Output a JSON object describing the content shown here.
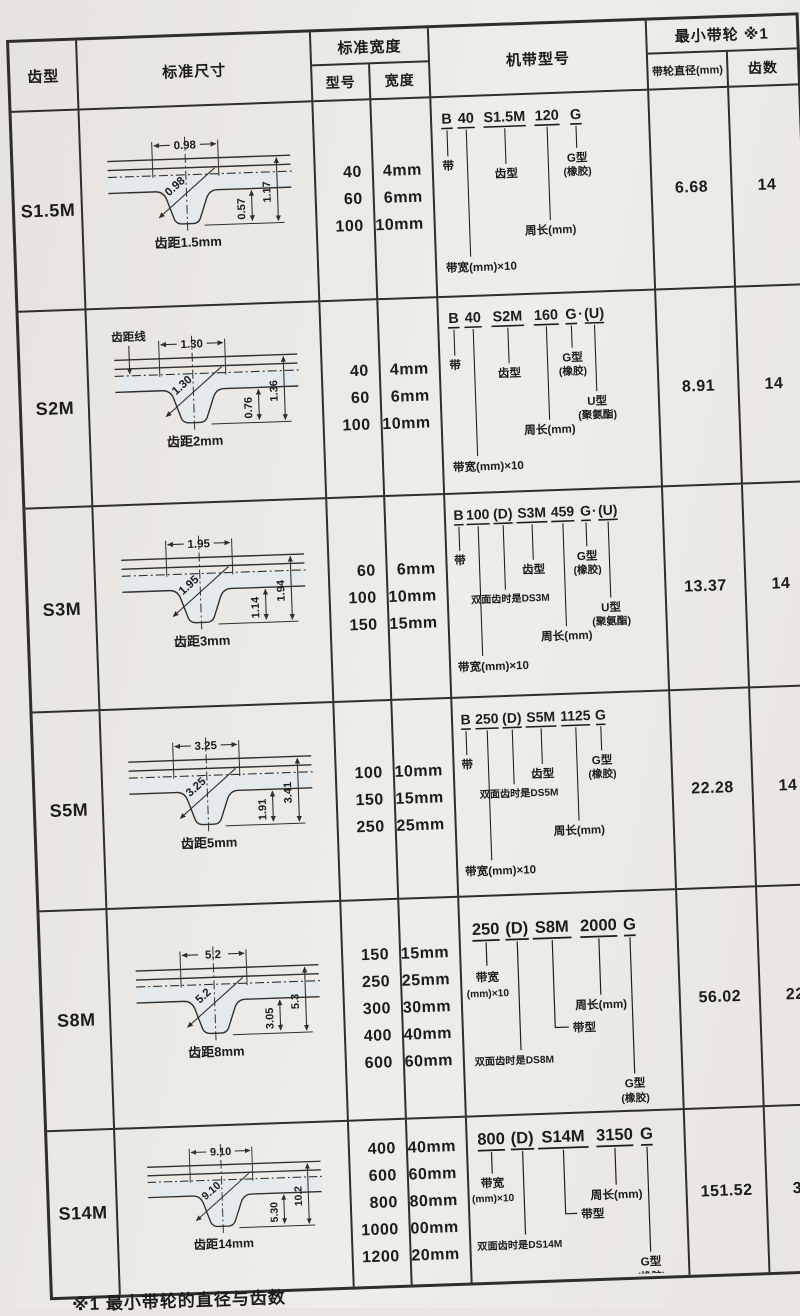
{
  "colors": {
    "paper": "#e9e6e1",
    "ink": "#1c1c1c",
    "grid_line": "#2e2e2e",
    "tooth_fill": "#e2e9ee"
  },
  "header": {
    "tooth_profile": "齿型",
    "standard_dims": "标准尺寸",
    "standard_width": "标准宽度",
    "model": "型号",
    "width": "宽度",
    "belt_model": "机带型号",
    "min_pulley": "最小带轮 ※1",
    "pulley_dia": "带轮直径(mm)",
    "teeth": "齿数"
  },
  "footnote": "※1 最小带轮的直径与齿数",
  "rows": [
    {
      "profile": "S1.5M",
      "diagram": {
        "top_width": "0.98",
        "tooth_width": "0.98",
        "tooth_height": "0.57",
        "total_height": "1.17",
        "pitch_label": "齿距1.5mm"
      },
      "models": [
        "40",
        "60",
        "100"
      ],
      "widths": [
        "4mm",
        "6mm",
        "10mm"
      ],
      "designation": {
        "belt_code": "B",
        "width_code": "40",
        "profile_code": "S1.5M",
        "length_code": "120",
        "type_code": "G",
        "label_belt": "带",
        "label_width": "带宽(mm)×10",
        "label_profile": "齿型",
        "label_length": "周长(mm)",
        "label_g1": "G型",
        "label_g2": "(橡胶)"
      },
      "pulley_dia": "6.68",
      "teeth": "14"
    },
    {
      "profile": "S2M",
      "diagram": {
        "top_width": "1.30",
        "tooth_width": "1.30",
        "tooth_height": "0.76",
        "total_height": "1.36",
        "pitch_label": "齿距2mm",
        "pitch_line_label": "齿距线"
      },
      "models": [
        "40",
        "60",
        "100"
      ],
      "widths": [
        "4mm",
        "6mm",
        "10mm"
      ],
      "designation": {
        "belt_code": "B",
        "width_code": "40",
        "profile_code": "S2M",
        "length_code": "160",
        "type_code": "G",
        "dot": "·",
        "u_code": "(U)",
        "label_belt": "带",
        "label_width": "带宽(mm)×10",
        "label_profile": "齿型",
        "label_length": "周长(mm)",
        "label_g1": "G型",
        "label_g2": "(橡胶)",
        "label_u1": "U型",
        "label_u2": "(聚氨酯)"
      },
      "pulley_dia": "8.91",
      "teeth": "14"
    },
    {
      "profile": "S3M",
      "diagram": {
        "top_width": "1.95",
        "tooth_width": "1.95",
        "tooth_height": "1.14",
        "total_height": "1.94",
        "pitch_label": "齿距3mm"
      },
      "models": [
        "60",
        "100",
        "150"
      ],
      "widths": [
        "6mm",
        "10mm",
        "15mm"
      ],
      "designation": {
        "belt_code": "B",
        "width_code": "100",
        "d_code": "(D)",
        "profile_code": "S3M",
        "length_code": "459",
        "type_code": "G",
        "dot": "·",
        "u_code": "(U)",
        "label_belt": "带",
        "label_width": "带宽(mm)×10",
        "label_d": "双面齿时是DS3M",
        "label_profile": "齿型",
        "label_length": "周长(mm)",
        "label_g1": "G型",
        "label_g2": "(橡胶)",
        "label_u1": "U型",
        "label_u2": "(聚氨酯)"
      },
      "pulley_dia": "13.37",
      "teeth": "14"
    },
    {
      "profile": "S5M",
      "diagram": {
        "top_width": "3.25",
        "tooth_width": "3.25",
        "tooth_height": "1.91",
        "total_height": "3.41",
        "pitch_label": "齿距5mm"
      },
      "models": [
        "100",
        "150",
        "250"
      ],
      "widths": [
        "10mm",
        "15mm",
        "25mm"
      ],
      "designation": {
        "belt_code": "B",
        "width_code": "250",
        "d_code": "(D)",
        "profile_code": "S5M",
        "length_code": "1125",
        "type_code": "G",
        "label_belt": "带",
        "label_width": "带宽(mm)×10",
        "label_d": "双面齿时是DS5M",
        "label_profile": "齿型",
        "label_length": "周长(mm)",
        "label_g1": "G型",
        "label_g2": "(橡胶)"
      },
      "pulley_dia": "22.28",
      "teeth": "14"
    },
    {
      "profile": "S8M",
      "diagram": {
        "top_width": "5.2",
        "tooth_width": "5.2",
        "tooth_height": "3.05",
        "total_height": "5.3",
        "pitch_label": "齿距8mm"
      },
      "models": [
        "150",
        "250",
        "300",
        "400",
        "600"
      ],
      "widths": [
        "15mm",
        "25mm",
        "30mm",
        "40mm",
        "60mm"
      ],
      "designation": {
        "width_code": "250",
        "d_code": "(D)",
        "profile_code": "S8M",
        "length_code": "2000",
        "type_code": "G",
        "label_width1": "带宽",
        "label_width2": "(mm)×10",
        "label_d": "双面齿时是DS8M",
        "label_type": "带型",
        "label_length": "周长(mm)",
        "label_g1": "G型",
        "label_g2": "(橡胶)"
      },
      "pulley_dia": "56.02",
      "teeth": "22"
    },
    {
      "profile": "S14M",
      "diagram": {
        "top_width": "9.10",
        "tooth_width": "9.10",
        "tooth_height": "5.30",
        "total_height": "10.2",
        "pitch_label": "齿距14mm"
      },
      "models": [
        "400",
        "600",
        "800",
        "1000",
        "1200"
      ],
      "widths": [
        "40mm",
        "60mm",
        "80mm",
        "100mm",
        "120mm"
      ],
      "designation": {
        "width_code": "800",
        "d_code": "(D)",
        "profile_code": "S14M",
        "length_code": "3150",
        "type_code": "G",
        "label_width1": "带宽",
        "label_width2": "(mm)×10",
        "label_d": "双面齿时是DS14M",
        "label_type": "带型",
        "label_length": "周长(mm)",
        "label_g1": "G型",
        "label_g2": "(橡胶)"
      },
      "pulley_dia": "151.52",
      "teeth": "34"
    }
  ]
}
